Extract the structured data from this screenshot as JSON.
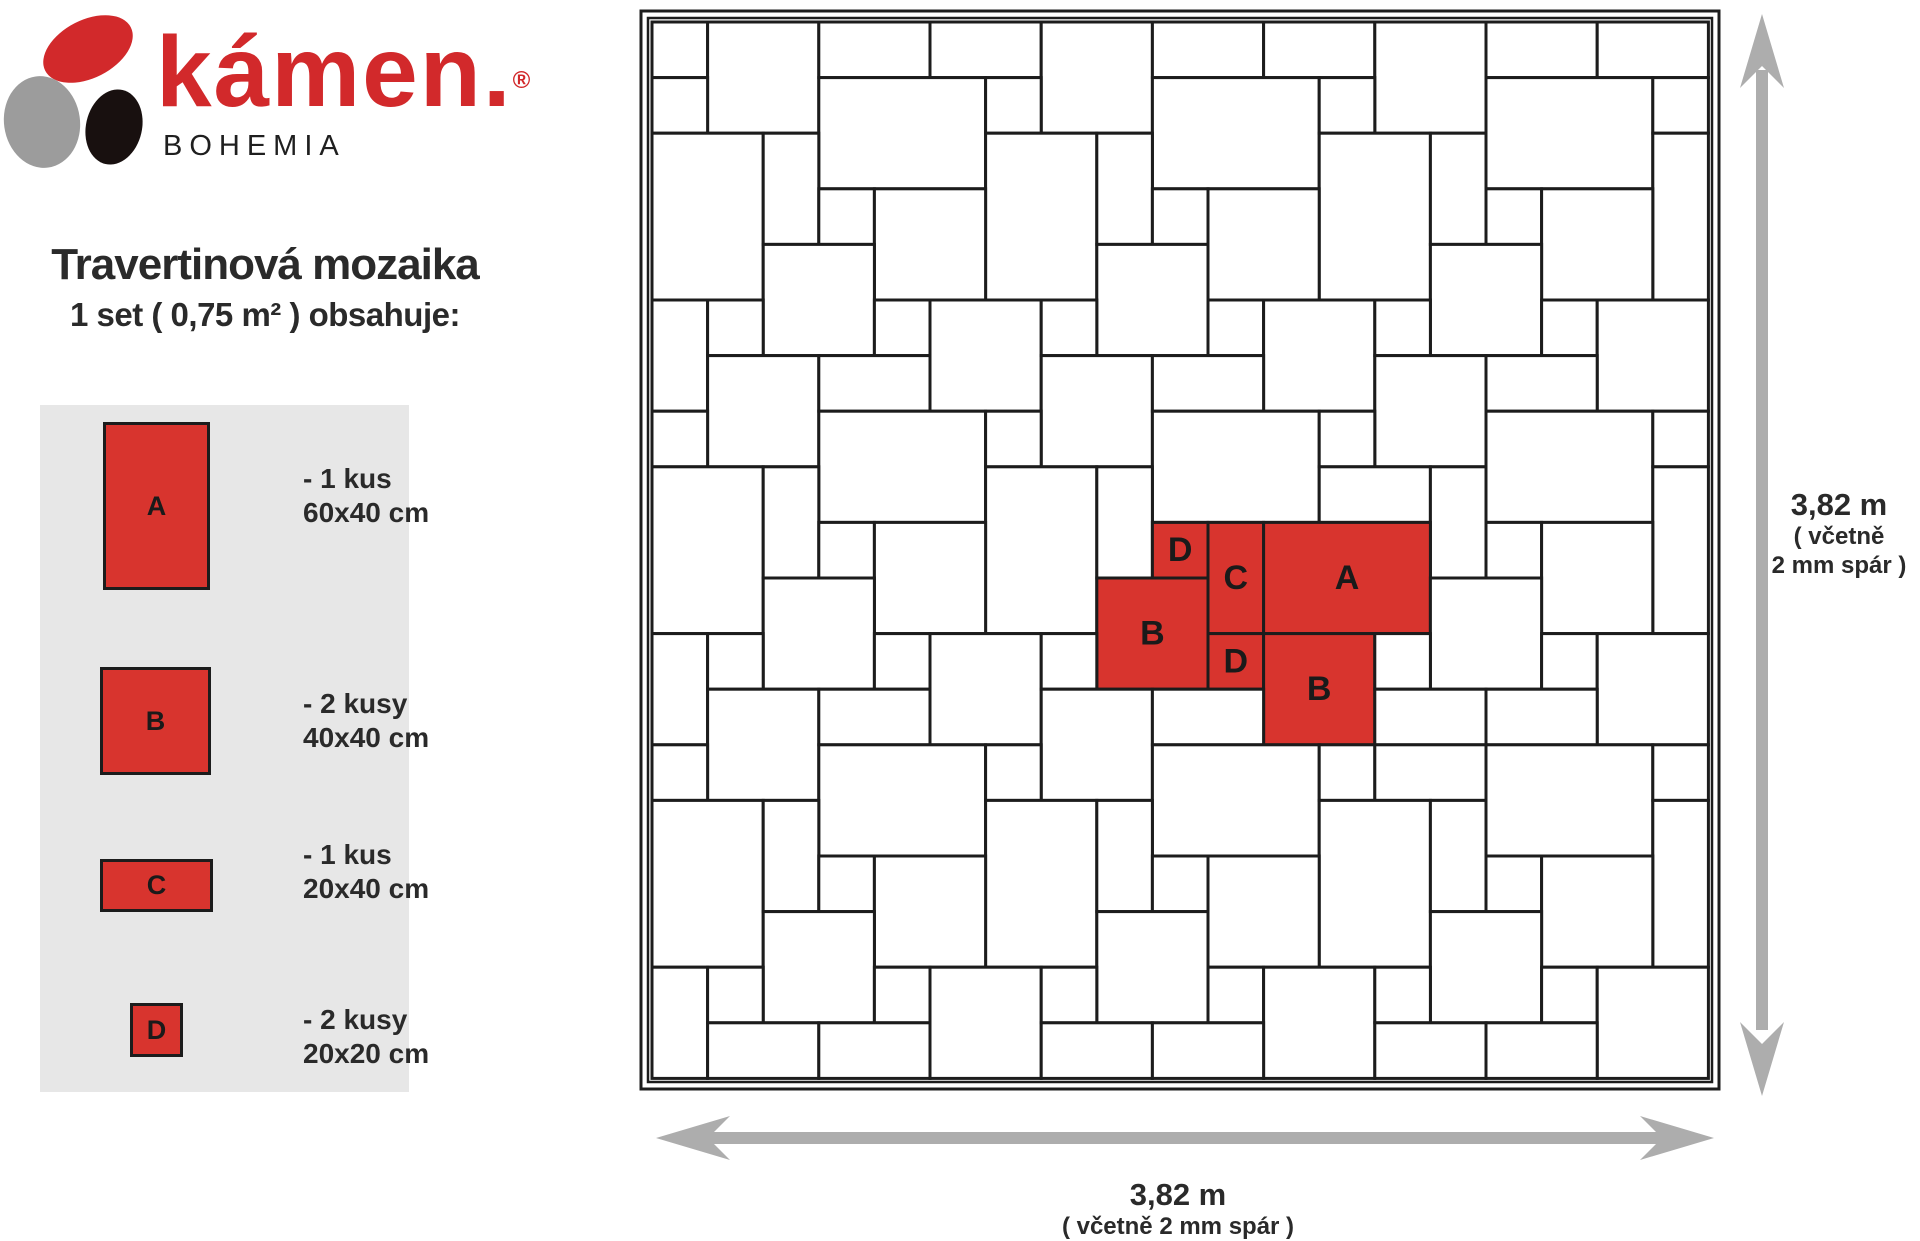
{
  "logo": {
    "brand": "kámen.",
    "registered": "®",
    "subbrand": "BOHEMIA"
  },
  "title": "Travertinová mozaika",
  "subtitle": "1 set ( 0,75 m² ) obsahuje:",
  "legend": {
    "items": [
      {
        "label": "A",
        "qty": "- 1 kus",
        "size": "60x40 cm"
      },
      {
        "label": "B",
        "qty": "- 2 kusy",
        "size": "40x40 cm"
      },
      {
        "label": "C",
        "qty": "- 1 kus",
        "size": "20x40 cm"
      },
      {
        "label": "D",
        "qty": "- 2 kusy",
        "size": "20x20 cm"
      }
    ]
  },
  "dimensions": {
    "right": {
      "value": "3,82 m",
      "note_line1": "( včetně",
      "note_line2": "2 mm spár )"
    },
    "bottom": {
      "value": "3,82 m",
      "note": "( včetně 2 mm spár )"
    }
  },
  "colors": {
    "brand_red": "#d2292b",
    "tile_red": "#d8342e",
    "tile_fill": "#ffffff",
    "tile_border": "#1c1c1c",
    "legend_bg": "#e7e7e7",
    "arrow_gray": "#adadad",
    "stone_gray": "#9c9c9c",
    "stone_black": "#18100f",
    "text_dark": "#2a2a2a"
  },
  "mosaic": {
    "grid_units": 19,
    "unit_cm": 20,
    "label_font_px": 34,
    "tiles": [
      {
        "c": 0,
        "r": 0,
        "w": 1,
        "h": 1,
        "t": "B"
      },
      {
        "c": 1,
        "r": 0,
        "w": 2,
        "h": 2,
        "t": "B"
      },
      {
        "c": 3,
        "r": 0,
        "w": 2,
        "h": 1,
        "t": "C"
      },
      {
        "c": 5,
        "r": 0,
        "w": 2,
        "h": 1,
        "t": "B"
      },
      {
        "c": 7,
        "r": 0,
        "w": 2,
        "h": 2,
        "t": "B"
      },
      {
        "c": 9,
        "r": 0,
        "w": 2,
        "h": 1,
        "t": "C"
      },
      {
        "c": 11,
        "r": 0,
        "w": 2,
        "h": 1,
        "t": "B"
      },
      {
        "c": 13,
        "r": 0,
        "w": 2,
        "h": 2,
        "t": "B"
      },
      {
        "c": 15,
        "r": 0,
        "w": 2,
        "h": 1,
        "t": "C"
      },
      {
        "c": 17,
        "r": 0,
        "w": 2,
        "h": 1,
        "t": "B"
      },
      {
        "c": 0,
        "r": 1,
        "w": 1,
        "h": 1,
        "t": "D"
      },
      {
        "c": 3,
        "r": 1,
        "w": 3,
        "h": 2,
        "t": "A"
      },
      {
        "c": 6,
        "r": 1,
        "w": 1,
        "h": 1,
        "t": "D"
      },
      {
        "c": 9,
        "r": 1,
        "w": 3,
        "h": 2,
        "t": "A"
      },
      {
        "c": 12,
        "r": 1,
        "w": 1,
        "h": 1,
        "t": "D"
      },
      {
        "c": 15,
        "r": 1,
        "w": 3,
        "h": 2,
        "t": "A"
      },
      {
        "c": 18,
        "r": 1,
        "w": 1,
        "h": 1,
        "t": "D"
      },
      {
        "c": 0,
        "r": 2,
        "w": 2,
        "h": 3,
        "t": "A"
      },
      {
        "c": 2,
        "r": 2,
        "w": 1,
        "h": 2,
        "t": "C"
      },
      {
        "c": 6,
        "r": 2,
        "w": 2,
        "h": 3,
        "t": "A"
      },
      {
        "c": 8,
        "r": 2,
        "w": 1,
        "h": 2,
        "t": "C"
      },
      {
        "c": 12,
        "r": 2,
        "w": 2,
        "h": 3,
        "t": "A"
      },
      {
        "c": 14,
        "r": 2,
        "w": 1,
        "h": 2,
        "t": "C"
      },
      {
        "c": 18,
        "r": 2,
        "w": 1,
        "h": 3,
        "t": "A"
      },
      {
        "c": 3,
        "r": 3,
        "w": 1,
        "h": 1,
        "t": "D"
      },
      {
        "c": 4,
        "r": 3,
        "w": 2,
        "h": 2,
        "t": "B"
      },
      {
        "c": 9,
        "r": 3,
        "w": 1,
        "h": 1,
        "t": "D"
      },
      {
        "c": 10,
        "r": 3,
        "w": 2,
        "h": 2,
        "t": "B"
      },
      {
        "c": 15,
        "r": 3,
        "w": 1,
        "h": 1,
        "t": "D"
      },
      {
        "c": 16,
        "r": 3,
        "w": 2,
        "h": 2,
        "t": "B"
      },
      {
        "c": 2,
        "r": 4,
        "w": 2,
        "h": 2,
        "t": "B"
      },
      {
        "c": 8,
        "r": 4,
        "w": 2,
        "h": 2,
        "t": "B"
      },
      {
        "c": 14,
        "r": 4,
        "w": 2,
        "h": 2,
        "t": "B"
      },
      {
        "c": 0,
        "r": 5,
        "w": 1,
        "h": 2,
        "t": "B"
      },
      {
        "c": 1,
        "r": 5,
        "w": 1,
        "h": 1,
        "t": "D"
      },
      {
        "c": 4,
        "r": 5,
        "w": 1,
        "h": 1,
        "t": "D"
      },
      {
        "c": 5,
        "r": 5,
        "w": 2,
        "h": 2,
        "t": "B"
      },
      {
        "c": 7,
        "r": 5,
        "w": 1,
        "h": 1,
        "t": "D"
      },
      {
        "c": 10,
        "r": 5,
        "w": 1,
        "h": 1,
        "t": "D"
      },
      {
        "c": 11,
        "r": 5,
        "w": 2,
        "h": 2,
        "t": "B"
      },
      {
        "c": 13,
        "r": 5,
        "w": 1,
        "h": 1,
        "t": "D"
      },
      {
        "c": 16,
        "r": 5,
        "w": 1,
        "h": 1,
        "t": "D"
      },
      {
        "c": 17,
        "r": 5,
        "w": 2,
        "h": 2,
        "t": "B"
      },
      {
        "c": 1,
        "r": 6,
        "w": 2,
        "h": 2,
        "t": "B"
      },
      {
        "c": 3,
        "r": 6,
        "w": 2,
        "h": 1,
        "t": "C"
      },
      {
        "c": 7,
        "r": 6,
        "w": 2,
        "h": 2,
        "t": "B"
      },
      {
        "c": 9,
        "r": 6,
        "w": 2,
        "h": 1,
        "t": "C"
      },
      {
        "c": 13,
        "r": 6,
        "w": 2,
        "h": 2,
        "t": "B"
      },
      {
        "c": 15,
        "r": 6,
        "w": 2,
        "h": 1,
        "t": "C"
      },
      {
        "c": 0,
        "r": 7,
        "w": 1,
        "h": 1,
        "t": "D"
      },
      {
        "c": 3,
        "r": 7,
        "w": 3,
        "h": 2,
        "t": "A"
      },
      {
        "c": 6,
        "r": 7,
        "w": 1,
        "h": 1,
        "t": "D"
      },
      {
        "c": 9,
        "r": 7,
        "w": 3,
        "h": 2,
        "t": "A"
      },
      {
        "c": 12,
        "r": 7,
        "w": 1,
        "h": 1,
        "t": "D"
      },
      {
        "c": 15,
        "r": 7,
        "w": 3,
        "h": 2,
        "t": "A"
      },
      {
        "c": 18,
        "r": 7,
        "w": 1,
        "h": 1,
        "t": "D"
      },
      {
        "c": 0,
        "r": 8,
        "w": 2,
        "h": 3,
        "t": "A"
      },
      {
        "c": 2,
        "r": 8,
        "w": 1,
        "h": 2,
        "t": "C"
      },
      {
        "c": 6,
        "r": 8,
        "w": 2,
        "h": 3,
        "t": "A"
      },
      {
        "c": 8,
        "r": 8,
        "w": 1,
        "h": 2,
        "t": "C"
      },
      {
        "c": 12,
        "r": 8,
        "w": 2,
        "h": 1,
        "t": "C"
      },
      {
        "c": 14,
        "r": 8,
        "w": 1,
        "h": 2,
        "t": "C"
      },
      {
        "c": 18,
        "r": 8,
        "w": 1,
        "h": 3,
        "t": "A"
      },
      {
        "c": 3,
        "r": 9,
        "w": 1,
        "h": 1,
        "t": "D"
      },
      {
        "c": 4,
        "r": 9,
        "w": 2,
        "h": 2,
        "t": "B"
      },
      {
        "c": 9,
        "r": 9,
        "w": 1,
        "h": 1,
        "t": "D",
        "red": 1,
        "lb": "D"
      },
      {
        "c": 10,
        "r": 9,
        "w": 1,
        "h": 2,
        "t": "C",
        "red": 1,
        "lb": "C"
      },
      {
        "c": 11,
        "r": 9,
        "w": 3,
        "h": 2,
        "t": "A",
        "red": 1,
        "lb": "A"
      },
      {
        "c": 15,
        "r": 9,
        "w": 1,
        "h": 1,
        "t": "D"
      },
      {
        "c": 16,
        "r": 9,
        "w": 2,
        "h": 2,
        "t": "B"
      },
      {
        "c": 2,
        "r": 10,
        "w": 2,
        "h": 2,
        "t": "B"
      },
      {
        "c": 8,
        "r": 10,
        "w": 2,
        "h": 2,
        "t": "B",
        "red": 1,
        "lb": "B"
      },
      {
        "c": 14,
        "r": 10,
        "w": 2,
        "h": 2,
        "t": "B"
      },
      {
        "c": 0,
        "r": 11,
        "w": 1,
        "h": 2,
        "t": "B"
      },
      {
        "c": 1,
        "r": 11,
        "w": 1,
        "h": 1,
        "t": "D"
      },
      {
        "c": 4,
        "r": 11,
        "w": 1,
        "h": 1,
        "t": "D"
      },
      {
        "c": 5,
        "r": 11,
        "w": 2,
        "h": 2,
        "t": "B"
      },
      {
        "c": 7,
        "r": 11,
        "w": 1,
        "h": 1,
        "t": "D"
      },
      {
        "c": 10,
        "r": 11,
        "w": 1,
        "h": 1,
        "t": "D",
        "red": 1,
        "lb": "D"
      },
      {
        "c": 11,
        "r": 11,
        "w": 2,
        "h": 2,
        "t": "B",
        "red": 1,
        "lb": "B"
      },
      {
        "c": 13,
        "r": 11,
        "w": 1,
        "h": 1,
        "t": "D"
      },
      {
        "c": 16,
        "r": 11,
        "w": 1,
        "h": 1,
        "t": "D"
      },
      {
        "c": 17,
        "r": 11,
        "w": 2,
        "h": 2,
        "t": "B"
      },
      {
        "c": 1,
        "r": 12,
        "w": 2,
        "h": 2,
        "t": "B"
      },
      {
        "c": 3,
        "r": 12,
        "w": 2,
        "h": 1,
        "t": "C"
      },
      {
        "c": 7,
        "r": 12,
        "w": 2,
        "h": 2,
        "t": "B"
      },
      {
        "c": 9,
        "r": 12,
        "w": 2,
        "h": 1,
        "t": "C"
      },
      {
        "c": 13,
        "r": 12,
        "w": 2,
        "h": 1,
        "t": "C"
      },
      {
        "c": 15,
        "r": 12,
        "w": 2,
        "h": 1,
        "t": "C"
      },
      {
        "c": 0,
        "r": 13,
        "w": 1,
        "h": 1,
        "t": "D"
      },
      {
        "c": 3,
        "r": 13,
        "w": 3,
        "h": 2,
        "t": "A"
      },
      {
        "c": 6,
        "r": 13,
        "w": 1,
        "h": 1,
        "t": "D"
      },
      {
        "c": 9,
        "r": 13,
        "w": 3,
        "h": 2,
        "t": "A"
      },
      {
        "c": 12,
        "r": 13,
        "w": 1,
        "h": 1,
        "t": "D"
      },
      {
        "c": 13,
        "r": 13,
        "w": 2,
        "h": 1,
        "t": "C"
      },
      {
        "c": 15,
        "r": 13,
        "w": 3,
        "h": 2,
        "t": "A"
      },
      {
        "c": 18,
        "r": 13,
        "w": 1,
        "h": 1,
        "t": "D"
      },
      {
        "c": 0,
        "r": 14,
        "w": 2,
        "h": 3,
        "t": "A"
      },
      {
        "c": 2,
        "r": 14,
        "w": 1,
        "h": 2,
        "t": "C"
      },
      {
        "c": 6,
        "r": 14,
        "w": 2,
        "h": 3,
        "t": "A"
      },
      {
        "c": 8,
        "r": 14,
        "w": 1,
        "h": 2,
        "t": "C"
      },
      {
        "c": 12,
        "r": 14,
        "w": 2,
        "h": 3,
        "t": "A"
      },
      {
        "c": 14,
        "r": 14,
        "w": 1,
        "h": 2,
        "t": "C"
      },
      {
        "c": 18,
        "r": 14,
        "w": 1,
        "h": 3,
        "t": "A"
      },
      {
        "c": 3,
        "r": 15,
        "w": 1,
        "h": 1,
        "t": "D"
      },
      {
        "c": 4,
        "r": 15,
        "w": 2,
        "h": 2,
        "t": "B"
      },
      {
        "c": 9,
        "r": 15,
        "w": 1,
        "h": 1,
        "t": "D"
      },
      {
        "c": 10,
        "r": 15,
        "w": 2,
        "h": 2,
        "t": "B"
      },
      {
        "c": 15,
        "r": 15,
        "w": 1,
        "h": 1,
        "t": "D"
      },
      {
        "c": 16,
        "r": 15,
        "w": 2,
        "h": 2,
        "t": "B"
      },
      {
        "c": 2,
        "r": 16,
        "w": 2,
        "h": 2,
        "t": "B"
      },
      {
        "c": 8,
        "r": 16,
        "w": 2,
        "h": 2,
        "t": "B"
      },
      {
        "c": 14,
        "r": 16,
        "w": 2,
        "h": 2,
        "t": "B"
      },
      {
        "c": 0,
        "r": 17,
        "w": 1,
        "h": 2,
        "t": "B"
      },
      {
        "c": 1,
        "r": 17,
        "w": 1,
        "h": 1,
        "t": "D"
      },
      {
        "c": 4,
        "r": 17,
        "w": 1,
        "h": 1,
        "t": "D"
      },
      {
        "c": 5,
        "r": 17,
        "w": 2,
        "h": 2,
        "t": "B"
      },
      {
        "c": 7,
        "r": 17,
        "w": 1,
        "h": 1,
        "t": "D"
      },
      {
        "c": 10,
        "r": 17,
        "w": 1,
        "h": 1,
        "t": "D"
      },
      {
        "c": 11,
        "r": 17,
        "w": 2,
        "h": 2,
        "t": "B"
      },
      {
        "c": 13,
        "r": 17,
        "w": 1,
        "h": 1,
        "t": "D"
      },
      {
        "c": 16,
        "r": 17,
        "w": 1,
        "h": 1,
        "t": "D"
      },
      {
        "c": 17,
        "r": 17,
        "w": 2,
        "h": 2,
        "t": "B"
      },
      {
        "c": 1,
        "r": 18,
        "w": 2,
        "h": 1,
        "t": "B"
      },
      {
        "c": 3,
        "r": 18,
        "w": 2,
        "h": 1,
        "t": "C"
      },
      {
        "c": 7,
        "r": 18,
        "w": 2,
        "h": 1,
        "t": "B"
      },
      {
        "c": 9,
        "r": 18,
        "w": 2,
        "h": 1,
        "t": "C"
      },
      {
        "c": 13,
        "r": 18,
        "w": 2,
        "h": 1,
        "t": "B"
      },
      {
        "c": 15,
        "r": 18,
        "w": 2,
        "h": 1,
        "t": "C"
      }
    ]
  }
}
